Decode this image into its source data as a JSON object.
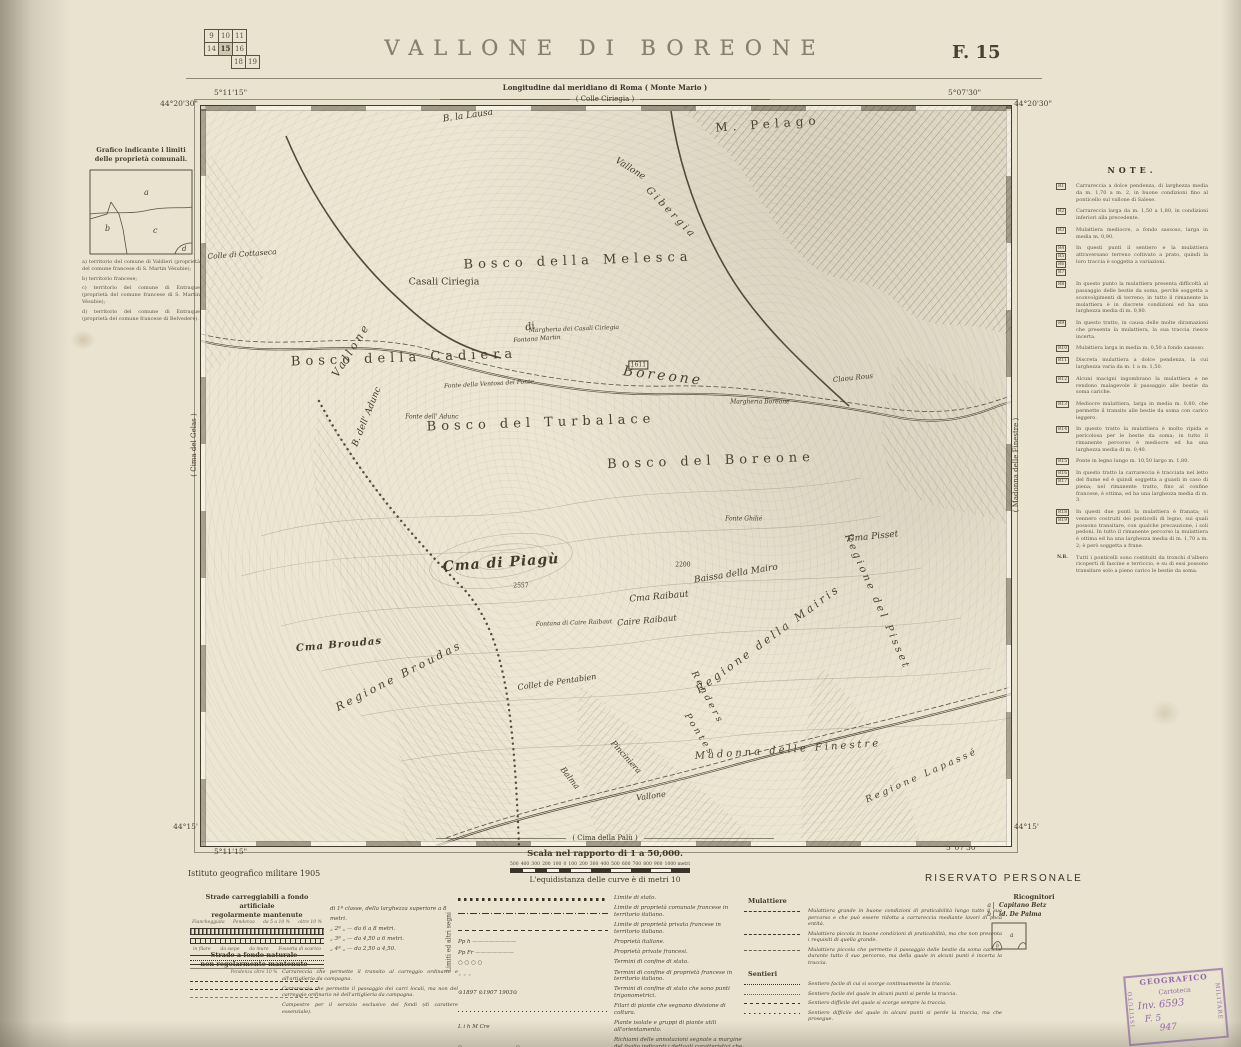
{
  "header": {
    "title": "VALLONE DI BOREONE",
    "sheet": "F. 15",
    "index_grid": {
      "rows": [
        [
          "9",
          "10",
          "11"
        ],
        [
          "14",
          "15",
          "16"
        ],
        [
          "",
          "18",
          "19"
        ]
      ],
      "highlighted": "15"
    }
  },
  "map": {
    "subtitle1": "Longitudine dal meridiano di Roma ( Monte Mario )",
    "subtitle2": "( Colle Ciriegia )",
    "bottom_label": "( Cima della Palù )",
    "left_edge_label": "( Cima del Gelas )",
    "right_edge_label": "( Madonna delle Finestre )",
    "corners": {
      "top_left_lon": "5°11'15\"",
      "top_left_lat": "44°20'30\"",
      "top_right_lon": "5°07'30\"",
      "top_right_lat": "44°20'30\"",
      "bottom_left_lat": "44°15'",
      "bottom_left_lon": "5°11'15\"",
      "bottom_right_lat": "44°15'",
      "bottom_right_lon": "5°07'30\""
    },
    "labels": [
      {
        "t": "B. la Lausa",
        "x": 33,
        "y": 1.4,
        "r": -8,
        "s": 9,
        "c": "i"
      },
      {
        "t": "M. Pelago",
        "x": 70,
        "y": 2.4,
        "r": -4,
        "s": 12,
        "c": "sp"
      },
      {
        "t": "Vallone",
        "x": 53,
        "y": 8.5,
        "r": 32,
        "s": 9,
        "c": "i"
      },
      {
        "t": "Gibergia",
        "x": 58,
        "y": 14.5,
        "r": 46,
        "s": 10,
        "c": "isp"
      },
      {
        "t": "Colle di Cottaseca",
        "x": 5,
        "y": 20,
        "r": -4,
        "s": 7.5,
        "c": "i"
      },
      {
        "t": "Bosco della Melesca",
        "x": 46.5,
        "y": 21,
        "r": -2,
        "s": 13,
        "c": "sp"
      },
      {
        "t": "Casali Ciriegia",
        "x": 30,
        "y": 23.8,
        "r": 0,
        "s": 9.5,
        "c": "n"
      },
      {
        "t": "Margheria dei Casali Ciriegia",
        "x": 46,
        "y": 30.2,
        "r": -2,
        "s": 6,
        "c": "i"
      },
      {
        "t": "Fontana Martin",
        "x": 41.5,
        "y": 31.5,
        "r": -4,
        "s": 6,
        "c": "i"
      },
      {
        "t": "Vallone",
        "x": 18.5,
        "y": 33,
        "r": -58,
        "s": 11,
        "c": "isp"
      },
      {
        "t": "di",
        "x": 40.6,
        "y": 29.8,
        "r": -12,
        "s": 10,
        "c": "i"
      },
      {
        "t": "Boreone",
        "x": 57,
        "y": 36.5,
        "r": 7,
        "s": 14,
        "c": "isp"
      },
      {
        "t": "Bosco della Cadiera",
        "x": 25,
        "y": 34,
        "r": -2,
        "s": 13,
        "c": "sp"
      },
      {
        "t": "Fonte della Ventosa del Ponte",
        "x": 35.5,
        "y": 37.6,
        "r": -3,
        "s": 6,
        "c": "i"
      },
      {
        "t": "1611",
        "x": 54,
        "y": 35,
        "r": 0,
        "s": 6,
        "c": "bx"
      },
      {
        "t": "Claou Rous",
        "x": 80.5,
        "y": 36.8,
        "r": -6,
        "s": 7,
        "c": "i"
      },
      {
        "t": "Margheria Boreone",
        "x": 69,
        "y": 40,
        "r": 0,
        "s": 6,
        "c": "i"
      },
      {
        "t": "Bosco del Turbalace",
        "x": 42,
        "y": 42.8,
        "r": -2,
        "s": 13,
        "c": "sp"
      },
      {
        "t": "B. dell' Adunc",
        "x": 20.5,
        "y": 42,
        "r": -68,
        "s": 9,
        "c": "i"
      },
      {
        "t": "Fonte dell' Adunc",
        "x": 28.5,
        "y": 42,
        "r": 0,
        "s": 6,
        "c": "i"
      },
      {
        "t": "Bosco del Boreone",
        "x": 63,
        "y": 48,
        "r": -2,
        "s": 13,
        "c": "sp"
      },
      {
        "t": "Fonte Ghilié",
        "x": 67,
        "y": 55.8,
        "r": 0,
        "s": 6,
        "c": "i"
      },
      {
        "t": "Cma Pisset",
        "x": 83,
        "y": 58.3,
        "r": -6,
        "s": 9,
        "c": "i"
      },
      {
        "t": "Cma di Piagù",
        "x": 37,
        "y": 61.8,
        "r": -4,
        "s": 14,
        "c": "scr"
      },
      {
        "t": "2557",
        "x": 39.5,
        "y": 64.8,
        "r": 0,
        "s": 6,
        "c": "n"
      },
      {
        "t": "2200",
        "x": 59.5,
        "y": 62,
        "r": 0,
        "s": 6,
        "c": "n"
      },
      {
        "t": "Baissa della Mairo",
        "x": 66,
        "y": 63.2,
        "r": -9,
        "s": 9,
        "c": "i"
      },
      {
        "t": "Cma Raibaut",
        "x": 56.5,
        "y": 66.3,
        "r": -5,
        "s": 9,
        "c": "i"
      },
      {
        "t": "Caire Raibaut",
        "x": 55,
        "y": 69.6,
        "r": -5,
        "s": 8.5,
        "c": "i"
      },
      {
        "t": "Fontana di Caire Raibaut",
        "x": 46,
        "y": 69.8,
        "r": -2,
        "s": 6,
        "c": "i"
      },
      {
        "t": "Regione della Mairis",
        "x": 70,
        "y": 72,
        "r": -36,
        "s": 11,
        "c": "isp"
      },
      {
        "t": "Regione del Pisset",
        "x": 83.5,
        "y": 67,
        "r": 66,
        "s": 10,
        "c": "isp"
      },
      {
        "t": "Cma Broudas",
        "x": 17,
        "y": 72.8,
        "r": -5,
        "s": 10,
        "c": "scr"
      },
      {
        "t": "Regione Broudas",
        "x": 24.5,
        "y": 77,
        "r": -27,
        "s": 11,
        "c": "isp"
      },
      {
        "t": "Collet de Pentabien",
        "x": 44,
        "y": 77.8,
        "r": -8,
        "s": 8,
        "c": "i"
      },
      {
        "t": "Renders",
        "x": 62.5,
        "y": 80,
        "r": 62,
        "s": 9,
        "c": "isp"
      },
      {
        "t": "Pontes",
        "x": 61.5,
        "y": 85,
        "r": 58,
        "s": 9,
        "c": "isp"
      },
      {
        "t": "Balma",
        "x": 45.5,
        "y": 90.8,
        "r": 52,
        "s": 8,
        "c": "i"
      },
      {
        "t": "Pinciniera",
        "x": 52.5,
        "y": 88,
        "r": 48,
        "s": 8,
        "c": "i"
      },
      {
        "t": "Vallone",
        "x": 55.5,
        "y": 93.2,
        "r": -8,
        "s": 8,
        "c": "i"
      },
      {
        "t": "Madonna delle Finestre",
        "x": 72.5,
        "y": 87,
        "r": -4,
        "s": 10,
        "c": "isp"
      },
      {
        "t": "Regione Lapassé",
        "x": 89,
        "y": 90.5,
        "r": -24,
        "s": 9,
        "c": "isp"
      }
    ]
  },
  "grafico": {
    "title1": "Grafico indicante i limiti",
    "title2": "delle proprietà comunali.",
    "letters": [
      "a",
      "b",
      "c",
      "d"
    ],
    "notes": [
      "a) territorio del comune di Valdieri (proprietà del comune francese di S. Martin Vésubie);",
      "b) territorio francese;",
      "c) territorio del comune di Entraque (proprietà del comune francese di S. Martin Vésubie);",
      "d) territorio del comune di Entraque (proprietà del comune francese di Belvedere)."
    ]
  },
  "notes": {
    "heading": "NOTE.",
    "entries": [
      {
        "refs": [
          "R1"
        ],
        "text": "Carrareccia a dolce pendenza, di larghezza media da m. 1,70 a m. 2, in buone condizioni fino al ponticello sul vallone di Salese."
      },
      {
        "refs": [
          "R2"
        ],
        "text": "Carrareccia larga da m. 1,50 a 1,80, in condizioni inferiori alla precedente."
      },
      {
        "refs": [
          "R3"
        ],
        "text": "Mulattiera mediocre, a fondo sassoso, larga in media m. 0,90."
      },
      {
        "refs": [
          "R4",
          "R5",
          "R6",
          "R7"
        ],
        "text": "In questi punti il sentiero e la mulattiera attraversano terreno coltivato a prato, quindi la loro traccia è soggetta a variazioni."
      },
      {
        "refs": [
          "R8"
        ],
        "text": "In questo punto la mulattiera presenta difficoltà al passaggio delle bestie da soma, perchè soggetta a sconvolgimenti di terreno; in tutto il rimanente la mulattiera è in discrete condizioni ed ha una larghezza media di m. 0,80."
      },
      {
        "refs": [
          "R9"
        ],
        "text": "In questo tratto, in causa delle molte diramazioni che presenta la mulattiera, la sua traccia riesce incerta."
      },
      {
        "refs": [
          "R10"
        ],
        "text": "Mulattiera larga in media m. 0,50 a fondo sassoso."
      },
      {
        "refs": [
          "R11"
        ],
        "text": "Discreta mulattiera a dolce pendenza, la cui larghezza varia da m. 1 a m. 1,50."
      },
      {
        "refs": [
          "R12"
        ],
        "text": "Alcuni macigni ingombrano la mulattiera e ne rendono malagevole il passaggio alle bestie da soma cariche."
      },
      {
        "refs": [
          "R13"
        ],
        "text": "Mediocre mulattiera, larga in media m. 0,80, che permette il transito alle bestie da soma con carico leggero."
      },
      {
        "refs": [
          "R14"
        ],
        "text": "In questo tratto la mulattiera è molto ripida e pericolosa per le bestie da soma; in tutto il rimanente percorso è mediocre ed ha una larghezza media di m. 0,40."
      },
      {
        "refs": [
          "R15"
        ],
        "text": "Ponte in legno lungo m. 10,50 largo m. 1,80."
      },
      {
        "refs": [
          "R16",
          "R17"
        ],
        "text": "In questo tratto la carrareccia è tracciata nel letto del fiume ed è quindi soggetta a guasti in caso di piena; nel rimanente tratto, fino al confine francese, è ottima, ed ha una larghezza media di m. 3."
      },
      {
        "refs": [
          "R18",
          "R19"
        ],
        "text": "In questi due punti la mulattiera è franata; vi vennero costruiti dei ponticelli di legno, sui quali possono transitare, con qualche precauzione, i soli pedoni. In tutto il rimanente percorso la mulattiera è ottima ed ha una larghezza media di m. 1,70 a m. 2; è però soggetta a frane."
      },
      {
        "refs": [
          "N.B."
        ],
        "text": "Tutti i ponticelli sono costituiti da tronchi d'albero ricoperti di fascine e terriccio, e su di essi possono transitare solo a pieno carico le bestie da soma."
      }
    ]
  },
  "scale": {
    "caption": "Scala nel rapporto di 1 a 50,000.",
    "ticks": [
      "500",
      "400",
      "300",
      "200",
      "100",
      "0",
      "100",
      "200",
      "300",
      "400",
      "500",
      "600",
      "700",
      "800",
      "900",
      "1000 metri"
    ],
    "equidistance": "L'equidistanza delle curve è di metri 10"
  },
  "footer": {
    "publisher": "Istituto geografico militare 1905",
    "reserved": "RISERVATO PERSONALE"
  },
  "legend": {
    "strade_title1": "Strade carreggiabili a fondo artificiale",
    "strade_title2": "regolarmente mantenute",
    "annotations1": [
      "Fiancheggiata",
      "Pendenza",
      "da 5 a 10 %",
      "oltre 10 %"
    ],
    "annotations2": [
      "in filare",
      "da siepe",
      "da muro",
      "Fossetta di scarico"
    ],
    "classes": [
      "di 1ª classe, della larghezza superiore a 8 metri.",
      "„ 2ª „  —  da 6 a 8 metri.",
      "„ 3ª „  —  da 4,50 a 6 metri.",
      "„ 4ª „  —  da 2,50 a 4,50."
    ],
    "naturale_title1": "Strade a fondo naturale",
    "naturale_title2": "non regolarmente mantenute",
    "naturale_ann": "Pendenza oltre 10 %",
    "naturale_desc": [
      "Carrareccia che permette il transito al carreggio ordinario e all'artiglieria da campagna.",
      "Carrareccia che permette il passaggio dei carri locali, ma non del carreggio ordinario nè dell'artiglieria da campagna.",
      "Campestre per il servizio esclusivo dei fondi (di carattere essenziale)."
    ],
    "limiti_vertical": "Limiti ed altri segni",
    "limiti": [
      {
        "sym": "state",
        "t": "Limite di stato."
      },
      {
        "sym": "comunale",
        "t": "Limite di proprietà comunale francese in territorio italiano."
      },
      {
        "sym": "privata",
        "t": "Limite di proprietà privata francese in territorio italiano."
      },
      {
        "sym": "pph",
        "t": "Proprietà italiane."
      },
      {
        "sym": "ppfr",
        "t": "Proprietà private francesi."
      },
      {
        "sym": "cippi",
        "t": "Termini di confine di stato."
      },
      {
        "sym": "cippifr",
        "t": "Termini di confine di proprietà francese in territorio italiano."
      },
      {
        "sym": "trig",
        "t": "Termini di confine di stato che sono punti trigonometrici."
      },
      {
        "sym": "filari",
        "t": "Filari di piante che segnano divisione di coltura."
      },
      {
        "sym": "piante",
        "t": "Piante isolate e gruppi di piante utili all'orientamento."
      },
      {
        "sym": "richiami",
        "t": "Richiami delle annotazioni segnate a margine del foglio indicanti i dettagli caratteristici che non possono risultare dal rilievo."
      }
    ],
    "mulattiere_title": "Mulattiere",
    "mulattiere": [
      {
        "sym": "mul1",
        "t": "Mulattiera grande in buone condizioni di praticabilità lungo tutto il suo percorso e che può essere ridotta a carrareccia mediante lavori di poca entità."
      },
      {
        "sym": "mul2",
        "t": "Mulattiera piccola in buone condizioni di praticabilità, ma che non presenta i requisiti di quella grande."
      },
      {
        "sym": "mul3",
        "t": "Mulattiera piccola che permette il passaggio delle bestie da soma cariche durante tutto il suo percorso, ma della quale in alcuni punti è incerta la traccia."
      }
    ],
    "sentieri_title": "Sentieri",
    "sentieri": [
      {
        "sym": "sen1",
        "t": "Sentiero facile di cui si scorge continuamente la traccia."
      },
      {
        "sym": "sen2",
        "t": "Sentiero facile del quale in alcuni punti si perde la traccia."
      },
      {
        "sym": "sen3",
        "t": "Sentiero difficile del quale si scorge sempre la traccia."
      },
      {
        "sym": "sen4",
        "t": "Sentiero difficile del quale in alcuni punti si perde la traccia, ma che prosegue."
      }
    ]
  },
  "ricognitori": {
    "title": "Ricognitori",
    "rows": [
      {
        "key": "a",
        "value": "Capitano Betz"
      },
      {
        "key": "b",
        "value": "id. De Palma"
      }
    ],
    "sketch_letters": [
      "a",
      "b"
    ]
  },
  "stamp": {
    "side_top": "GEOGRAFICO",
    "side_left": "ISTITUTO",
    "side_right": "MILITARE",
    "line1": "Cartoteca",
    "line2": "Inv. 6593",
    "line3": "F. 5",
    "line4": "947"
  }
}
